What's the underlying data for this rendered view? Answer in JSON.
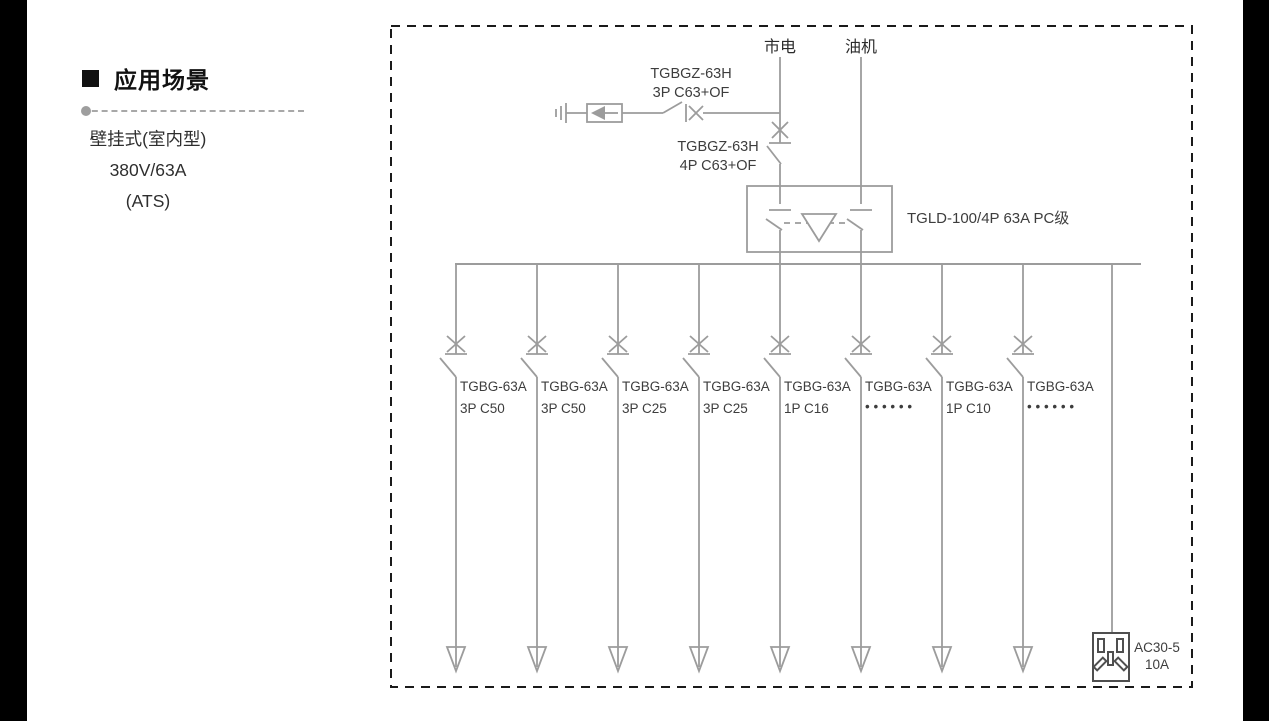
{
  "colors": {
    "wire_gray": "#9c9c9c",
    "border_black": "#1a1a1a",
    "socket_gray": "#4f4f4f",
    "side_bars": "#000000"
  },
  "icons": {
    "section_bullet": "black-square",
    "separator_dot": "gray-dot",
    "spd": "surge-protector-arrow-box",
    "ground": "earth-ground",
    "ats_linkage": "interlock-triangle",
    "load_arrow": "open-down-arrow",
    "socket": "power-socket"
  },
  "sidebar": {
    "title": "应用场景",
    "lines": [
      "壁挂式(室内型)",
      "380V/63A",
      "(ATS)"
    ]
  },
  "diagram": {
    "sources": {
      "mains": "市电",
      "generator": "油机"
    },
    "spd_breaker": {
      "line1": "TGBGZ-63H",
      "line2": "3P C63+OF"
    },
    "main_breaker": {
      "line1": "TGBGZ-63H",
      "line2": "4P C63+OF"
    },
    "ats": {
      "label": "TGLD-100/4P 63A PC级"
    },
    "branches": [
      {
        "model": "TGBG-63A",
        "spec": "3P C50"
      },
      {
        "model": "TGBG-63A",
        "spec": "3P C50"
      },
      {
        "model": "TGBG-63A",
        "spec": "3P C25"
      },
      {
        "model": "TGBG-63A",
        "spec": "3P C25"
      },
      {
        "model": "TGBG-63A",
        "spec": "1P C16"
      },
      {
        "model": "TGBG-63A",
        "spec": "• • • • • •"
      },
      {
        "model": "TGBG-63A",
        "spec": "1P C10"
      },
      {
        "model": "TGBG-63A",
        "spec": "• • • • • •"
      }
    ],
    "socket": {
      "line1": "AC30-5",
      "line2": "10A"
    }
  }
}
